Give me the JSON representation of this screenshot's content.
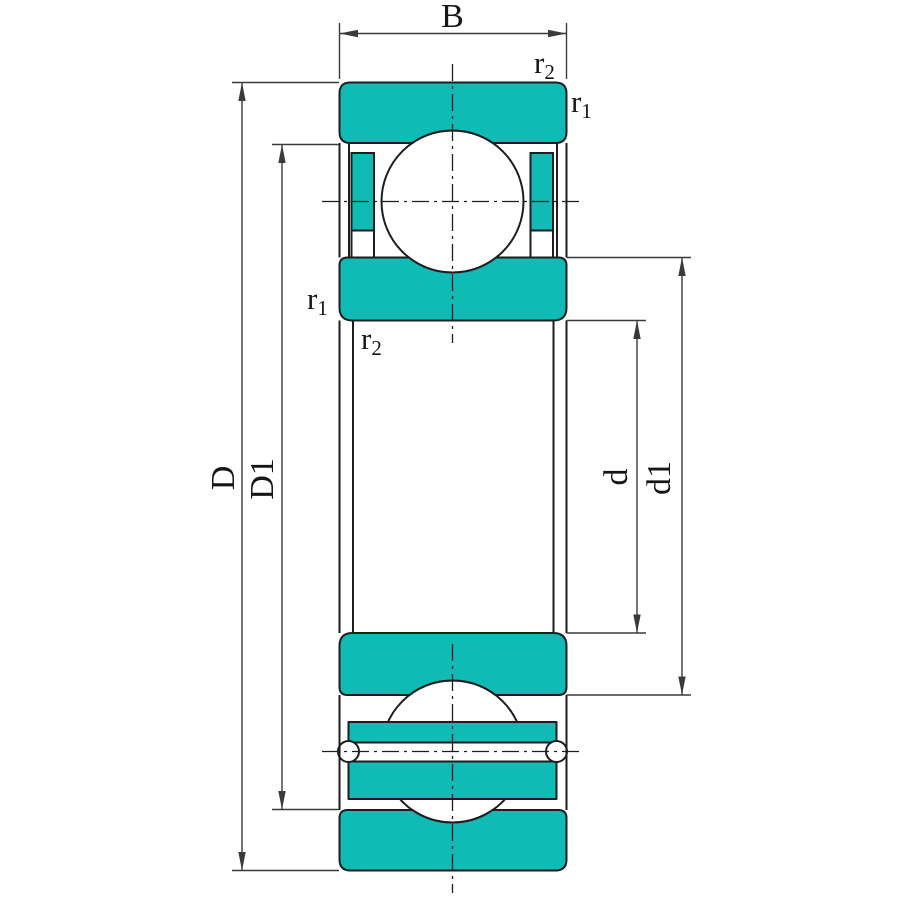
{
  "colors": {
    "ring_fill": "#10bab5",
    "outline": "#1e1e1e",
    "dim_line": "#3a3a3a",
    "background": "#ffffff"
  },
  "dimensions": {
    "width_label": "B",
    "outer_diameter_label": "D",
    "outer_race_diameter_label": "D1",
    "bore_diameter_label": "d",
    "inner_race_diameter_label": "d1"
  },
  "chamfer_labels": {
    "outer_ring_outside": {
      "base": "r",
      "sub": "2"
    },
    "outer_ring_face": {
      "base": "r",
      "sub": "1"
    },
    "inner_ring_face": {
      "base": "r",
      "sub": "1"
    },
    "inner_ring_bore": {
      "base": "r",
      "sub": "2"
    }
  }
}
